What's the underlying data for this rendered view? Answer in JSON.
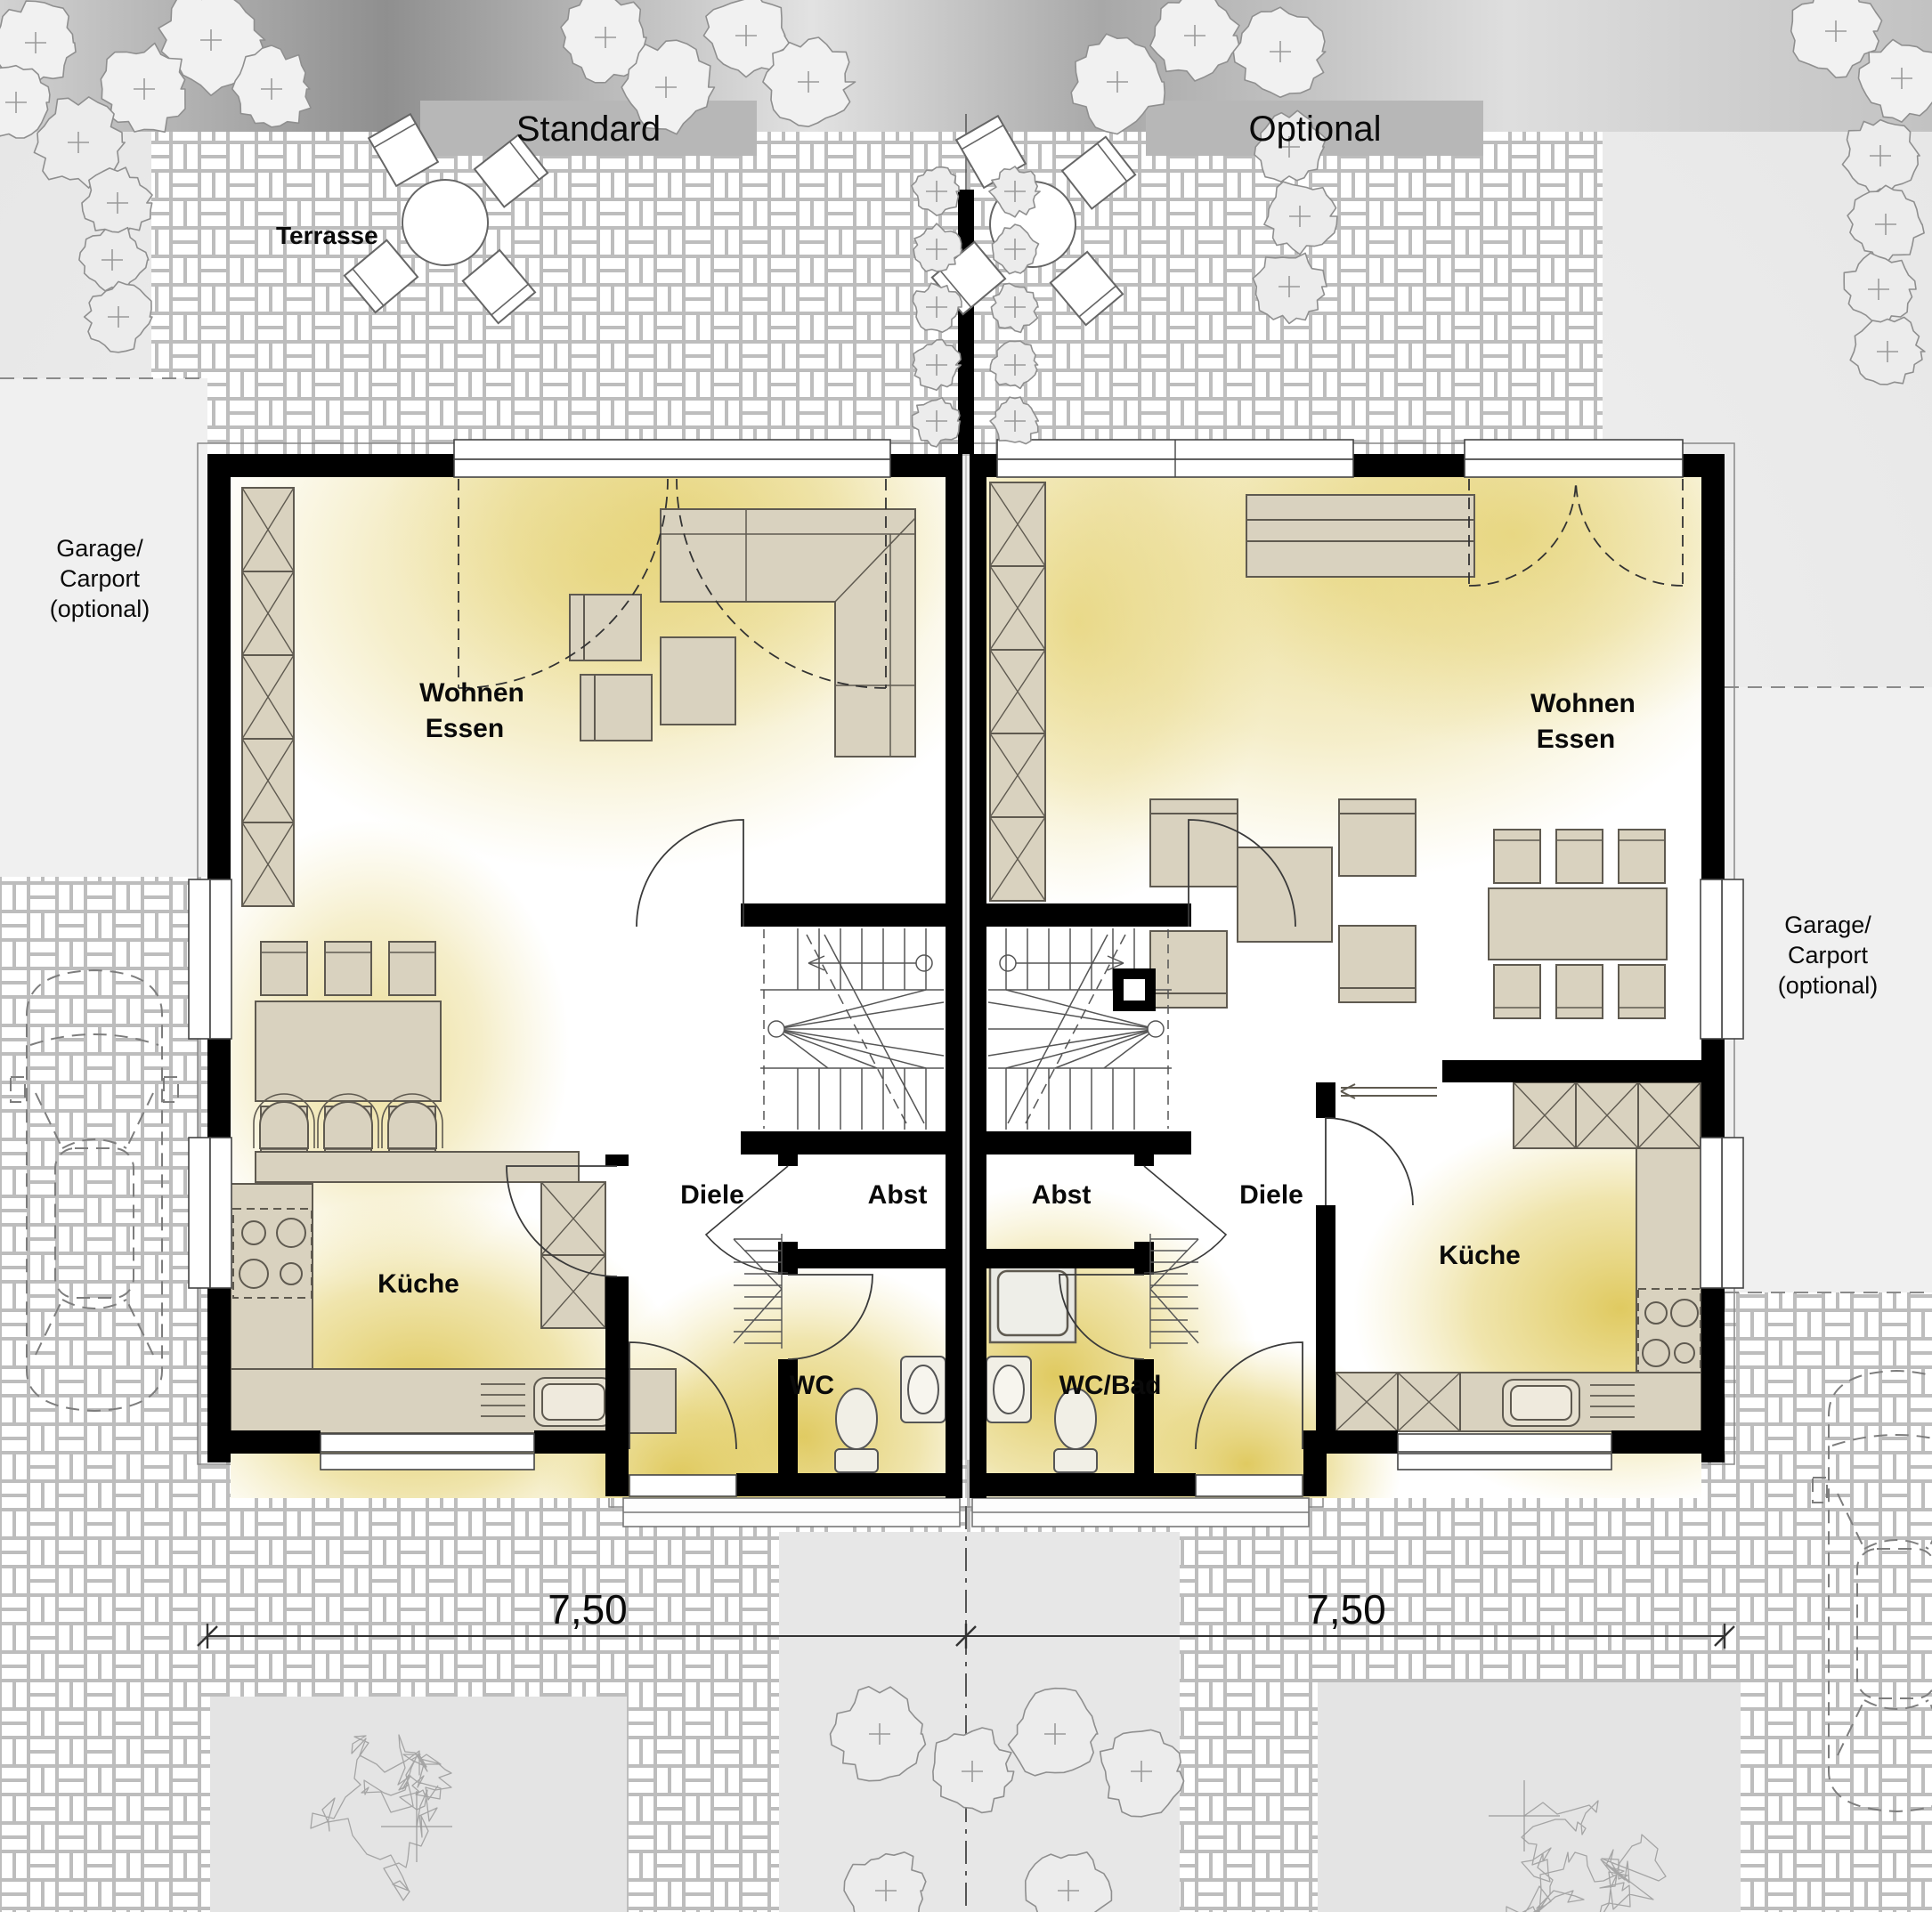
{
  "headers": {
    "standard": "Standard",
    "optional": "Optional"
  },
  "site": {
    "terrace": "Terrasse",
    "garage_left": [
      "Garage/",
      "Carport",
      "(optional)"
    ],
    "garage_right": [
      "Garage/",
      "Carport",
      "(optional)"
    ]
  },
  "left_unit": {
    "living": [
      "Wohnen",
      "Essen"
    ],
    "kitchen": "Küche",
    "hall": "Diele",
    "storage": "Abst",
    "bath": "WC",
    "width_dim": "7,50"
  },
  "right_unit": {
    "living": [
      "Wohnen",
      "Essen"
    ],
    "kitchen": "Küche",
    "hall": "Diele",
    "storage": "Abst",
    "bath": "WC/Bad",
    "width_dim": "7,50"
  },
  "colors": {
    "wall": "#000000",
    "furniture_fill": "#d9d2bf",
    "furniture_stroke": "#5f5a50",
    "glow": "#e2c96a",
    "paving_line": "#bdbdbd",
    "header_box": "#b7b7b7",
    "site_gray": "#e7e7e7",
    "tree_stroke": "#8f8f8f"
  }
}
